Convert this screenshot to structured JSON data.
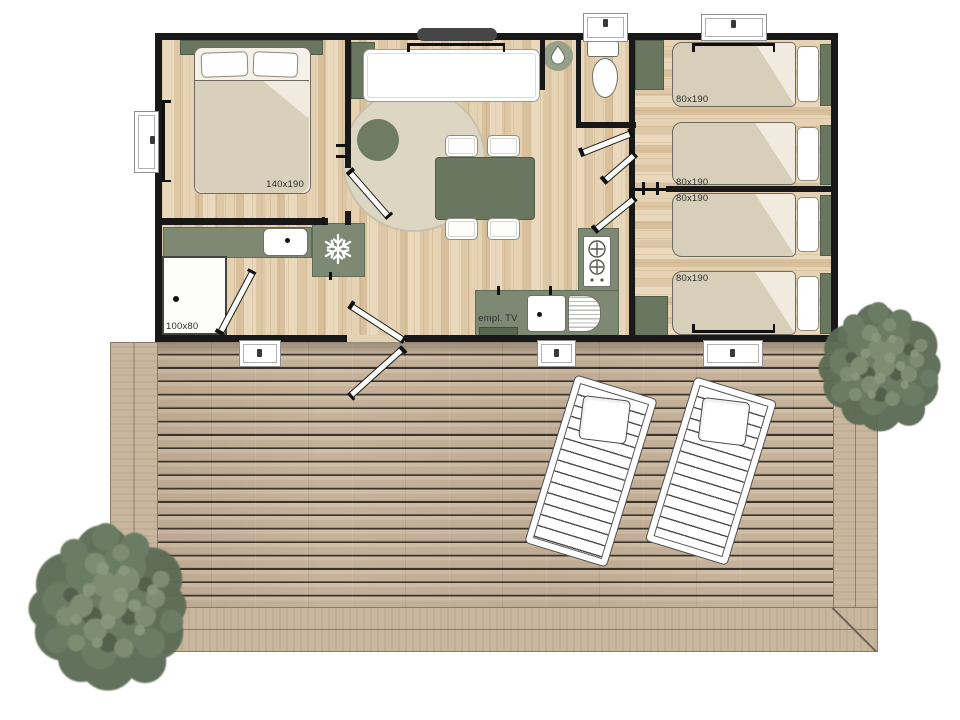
{
  "plan": {
    "type": "floor-plan",
    "description": "Mobile home floor plan with wooden terrace, two sun loungers and two trees"
  },
  "labels": {
    "master_bed": "140x190",
    "single_beds": [
      "80x190",
      "80x190",
      "80x190",
      "80x190"
    ],
    "shower": "100x80",
    "tv": "empl. TV"
  },
  "icons": {
    "fridge": "snowflake-icon",
    "shower_room": "water-drop-icon"
  },
  "colors": {
    "wall": "#181818",
    "sage": "#7d8972",
    "sage_dark": "#697660",
    "interior_wood": "#e2cfae",
    "deck_wood": "#c9b69e",
    "mattress": "#d8cfba",
    "tree_canopy": "#66755e"
  }
}
